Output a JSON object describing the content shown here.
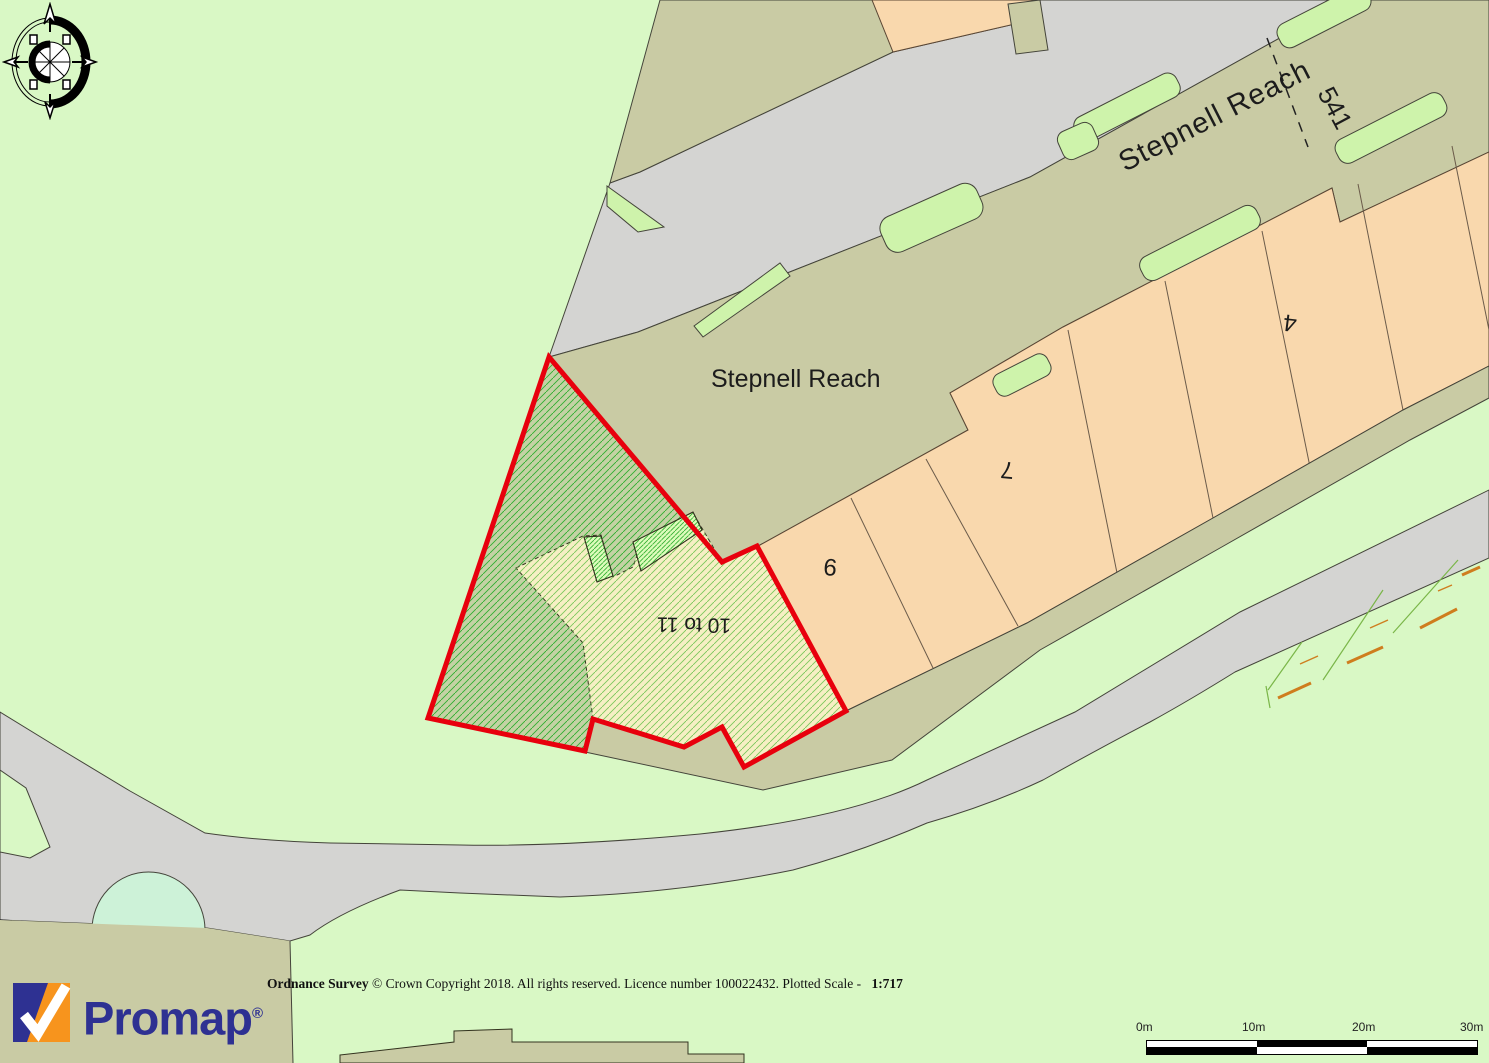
{
  "map": {
    "street_label_angled": "Stepnell Reach",
    "street_label_horizontal": "Stepnell Reach",
    "house_number_541": "541",
    "house_number_4": "4",
    "house_number_7": "7",
    "house_number_9": "9",
    "plot_label": "10 to 11",
    "colors": {
      "background_green": "#d9f8c5",
      "road_grey": "#d4d4d2",
      "track_khaki": "#c9cba4",
      "building_peach": "#f9d8ad",
      "verge_green": "#cef3ab",
      "pond_mint": "#cdf2d8",
      "plot_outline_red": "#e8000d",
      "plot_fill_olive": "#c4d2a4",
      "plot_building_cream": "#f6efc4",
      "hatch_green": "#2fae2f"
    }
  },
  "footer": {
    "copyright_bold_prefix": "Ordnance Survey",
    "copyright_mid": " © Crown Copyright 2018. All rights reserved. Licence number 100022432. Plotted Scale - ",
    "plotted_scale": "1:717"
  },
  "scale_bar": {
    "labels": [
      "0m",
      "10m",
      "20m",
      "30m"
    ]
  },
  "logo": {
    "name": "Promap",
    "registered": "®"
  },
  "icons": {
    "compass": "compass-rose-icon"
  }
}
